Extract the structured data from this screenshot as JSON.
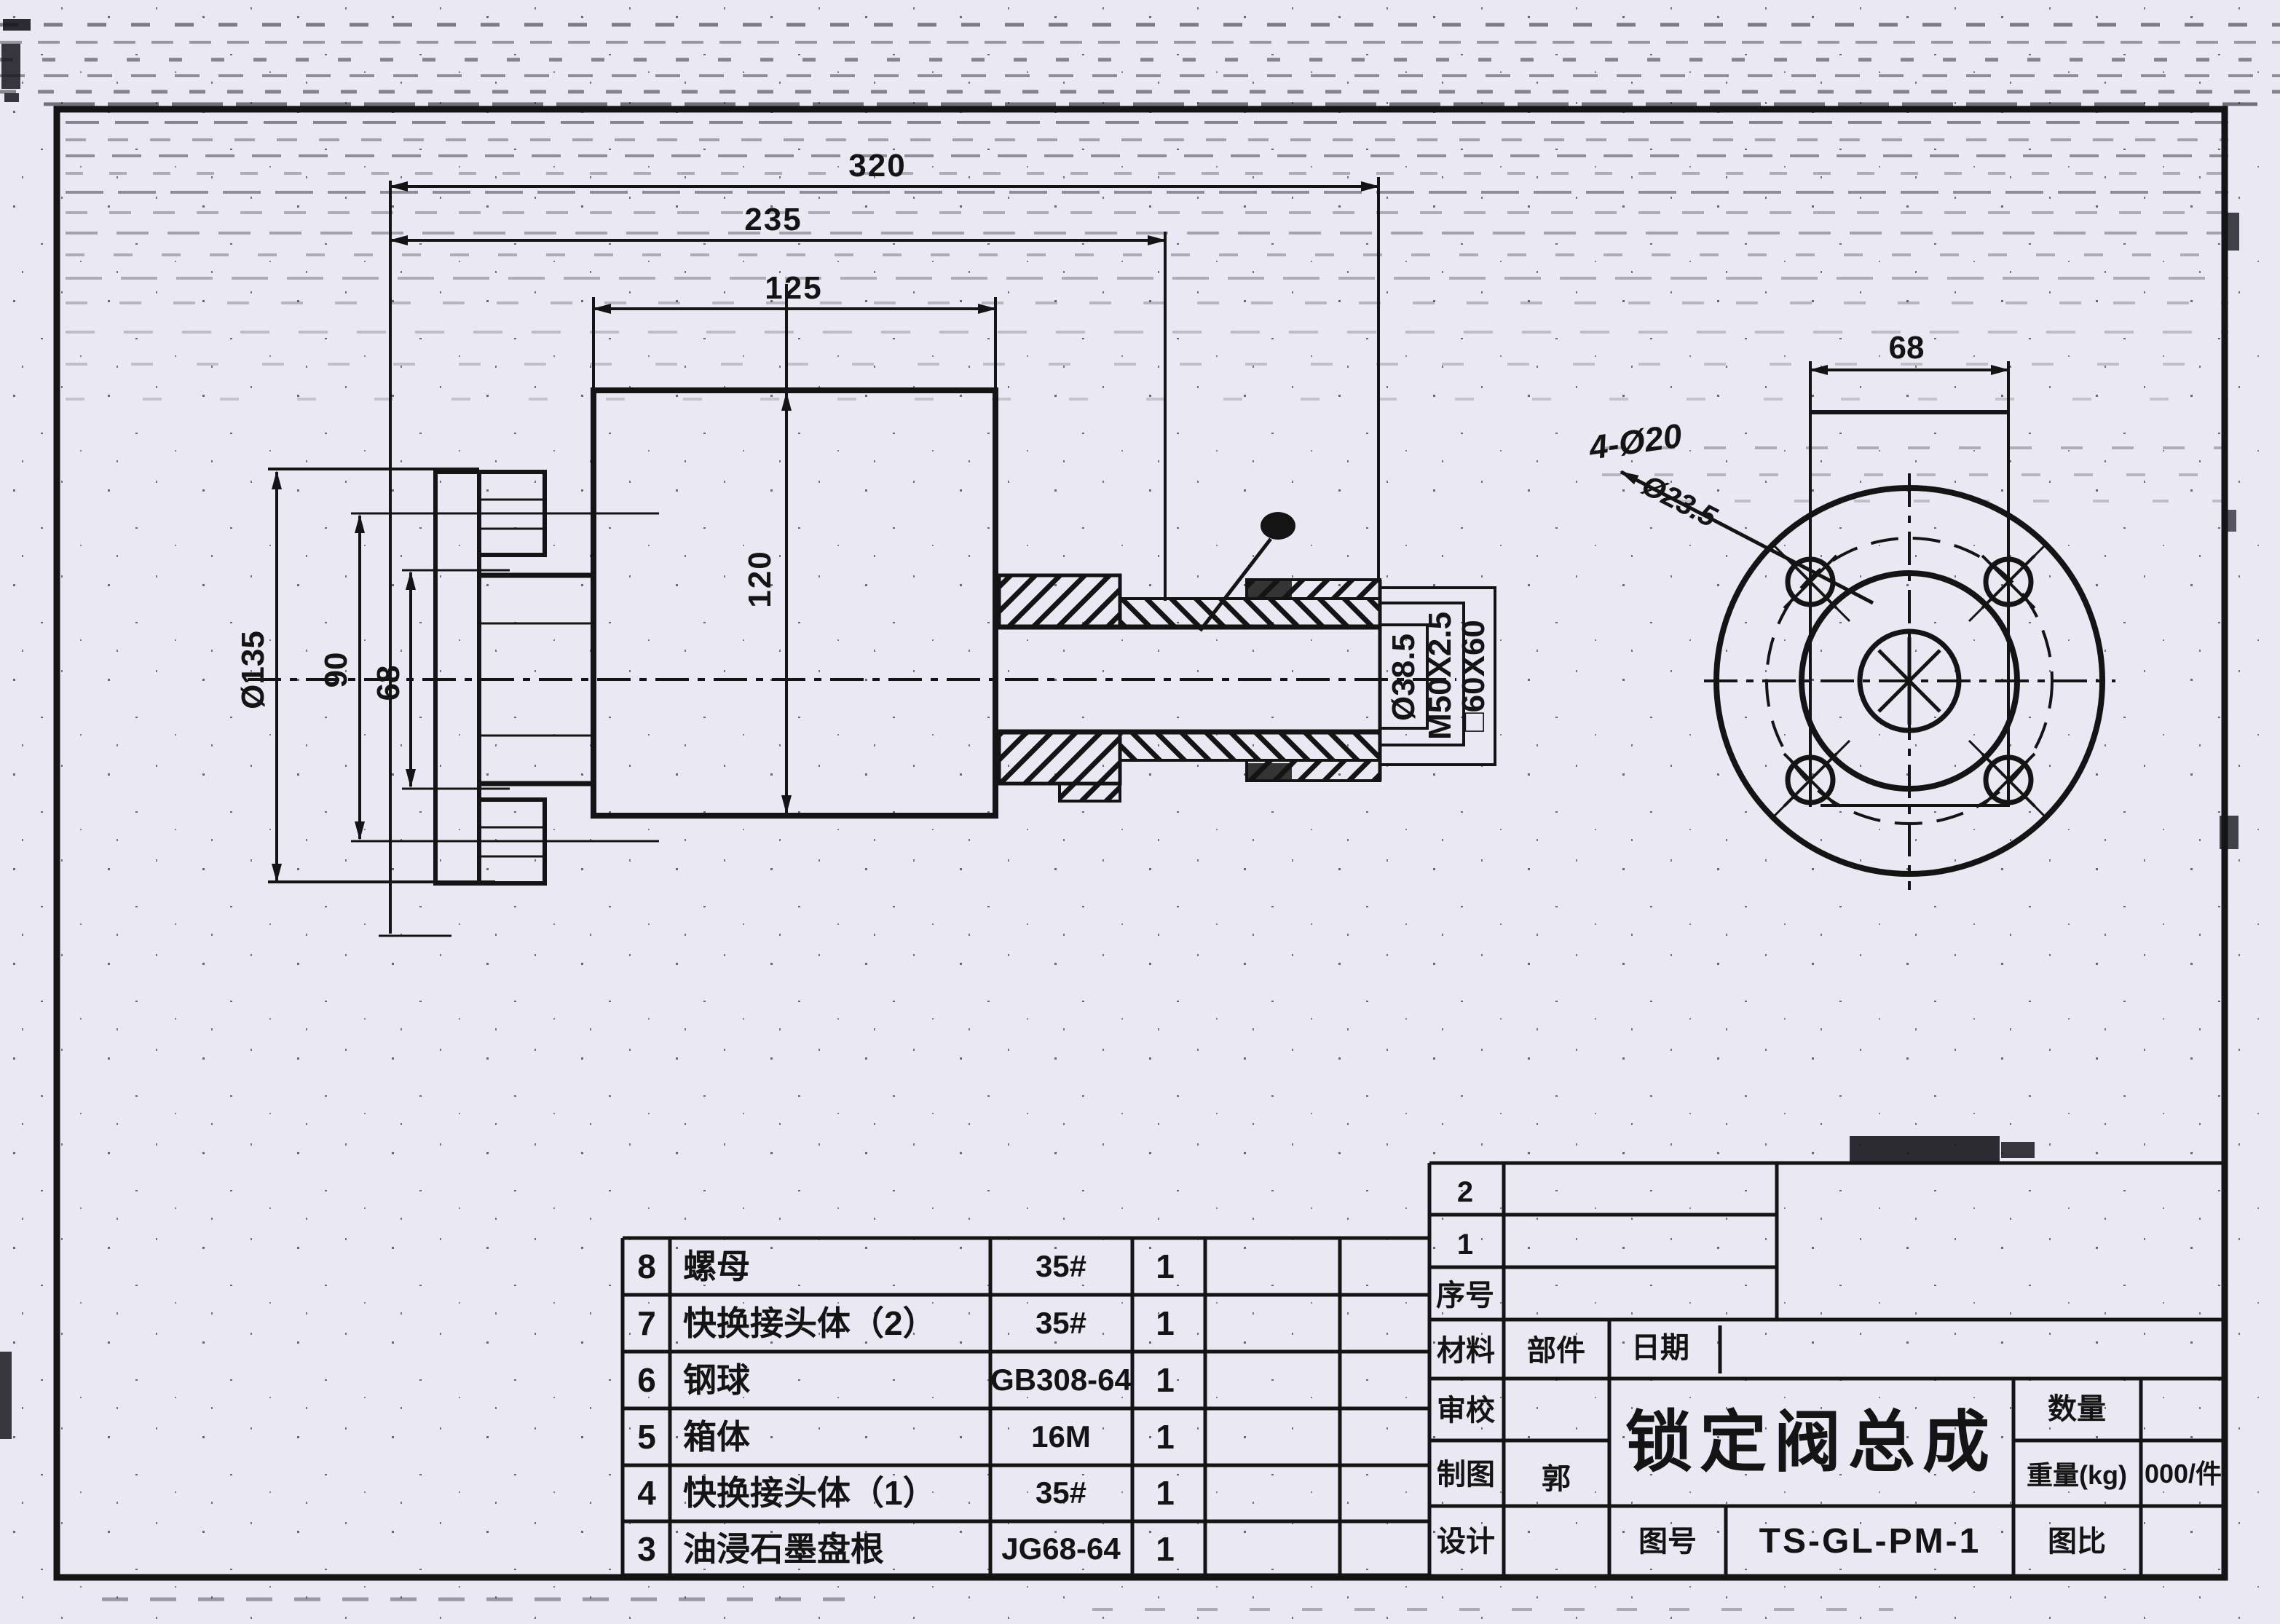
{
  "colors": {
    "paper": "#eae8f2",
    "ink": "#141414"
  },
  "front_view": {
    "dim_320": "320",
    "dim_235": "235",
    "dim_125": "125",
    "dim_120": "120",
    "stem_labels": {
      "bore": "Ø38.5",
      "thread": "M50X2.5",
      "square": "□60X60"
    }
  },
  "side_view": {
    "dim_flange_od": "Ø135",
    "dim_bolt_circle": "90",
    "dim_hub": "68"
  },
  "flange_view": {
    "dim_bolt_spacing": "68",
    "note_holes": "4-Ø20",
    "note_struck": "Ø23.5"
  },
  "parts_table": {
    "rows": [
      {
        "no": "8",
        "name": "螺母",
        "spec": "35#",
        "qty": "1"
      },
      {
        "no": "7",
        "name": "快换接头体（2）",
        "spec": "35#",
        "qty": "1"
      },
      {
        "no": "6",
        "name": "钢球",
        "spec": "GB308-64",
        "qty": "1"
      },
      {
        "no": "5",
        "name": "箱体",
        "spec": "16M",
        "qty": "1"
      },
      {
        "no": "4",
        "name": "快换接头体（1）",
        "spec": "35#",
        "qty": "1"
      },
      {
        "no": "3",
        "name": "油浸石墨盘根",
        "spec": "JG68-64",
        "qty": "1"
      }
    ]
  },
  "title_block": {
    "seq_row2": "2",
    "seq_row1": "1",
    "seq_label": "序号",
    "material_label": "材料",
    "part_label": "部件",
    "date_label": "日期",
    "check_label": "审校",
    "draft_label": "制图",
    "drafter": "郭",
    "design_label": "设计",
    "drawing_no_label": "图号",
    "drawing_no": "TS-GL-PM-1",
    "qty_label": "数量",
    "weight_label": "重量(kg)",
    "weight_value": "000/件",
    "scale_label": "图比",
    "title": "锁定阀总成"
  }
}
